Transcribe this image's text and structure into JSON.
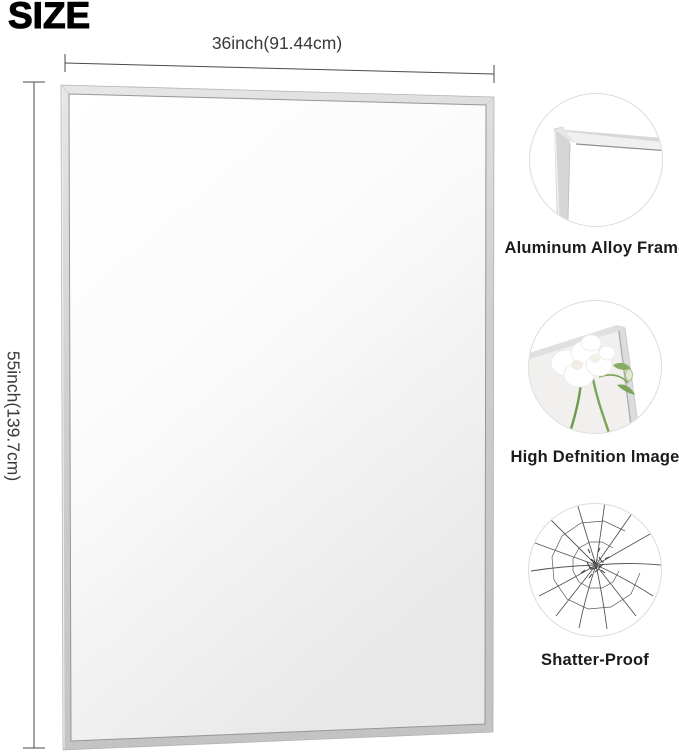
{
  "title": "SIZE",
  "dimensions": {
    "width": "36inch(91.44cm)",
    "height": "55inch(139.7cm)"
  },
  "features": [
    {
      "icon": "frame-corner-icon",
      "label": "Aluminum Alloy Frame"
    },
    {
      "icon": "flower-mirror-icon",
      "label": "High Defnition lmage"
    },
    {
      "icon": "shattered-glass-icon",
      "label": "Shatter-Proof"
    }
  ],
  "colors": {
    "frame_silver": "#cfcfcf",
    "mirror_highlight": "#ffffff",
    "mirror_shade": "#e8e8e8",
    "dimension_line": "#4a4a4a",
    "label_text": "#1c1c1c",
    "stem_green": "#6f9a4b"
  }
}
